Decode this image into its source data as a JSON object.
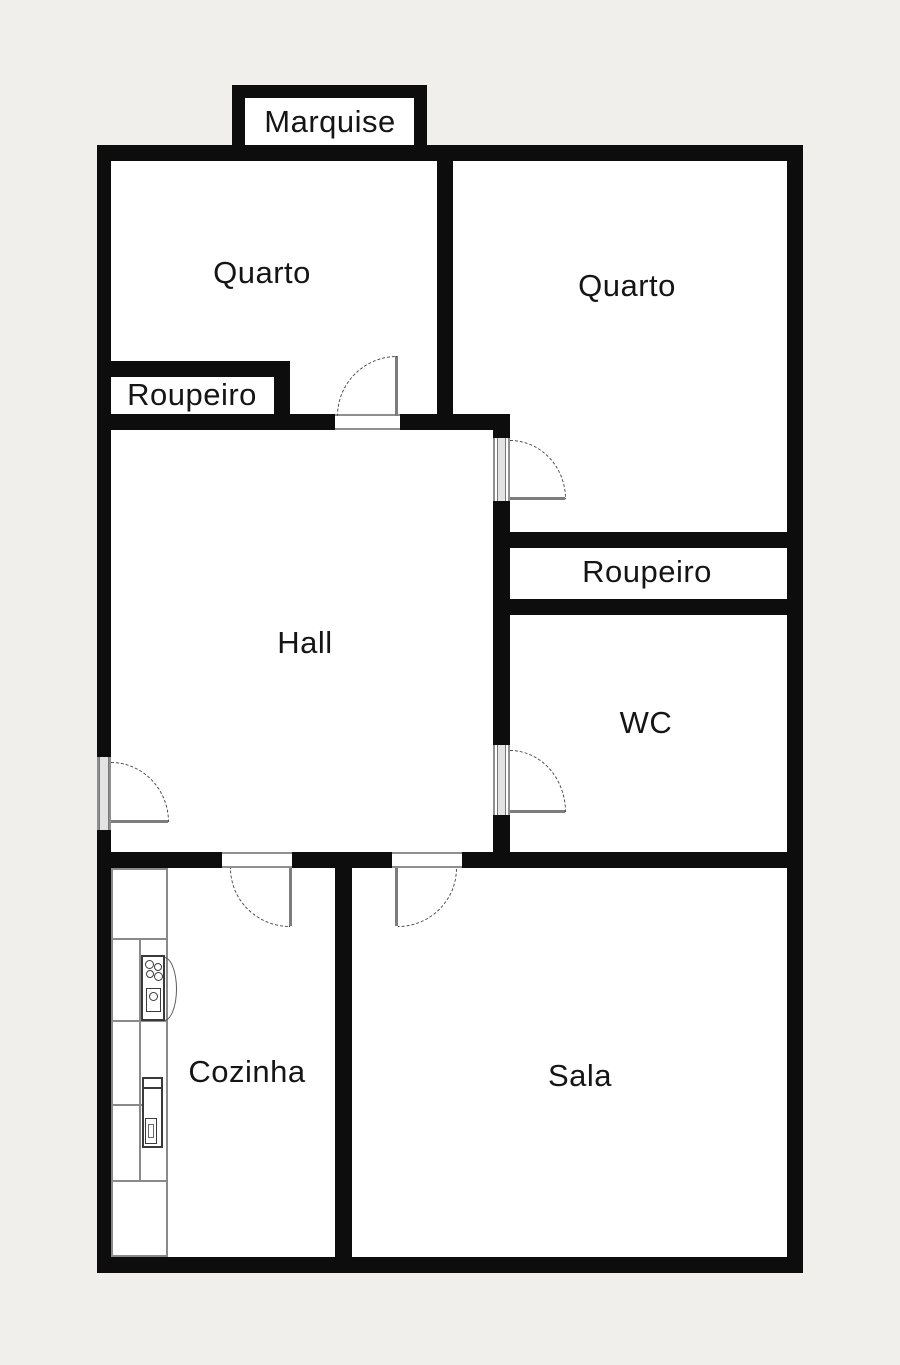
{
  "type": "floor-plan",
  "colors": {
    "wall": "#0d0d0d",
    "floor": "#ffffff",
    "background": "#f0efeb",
    "fixture_line": "#777777",
    "text": "#151515"
  },
  "rooms": {
    "marquise": {
      "label": "Marquise"
    },
    "quarto_left": {
      "label": "Quarto"
    },
    "quarto_right": {
      "label": "Quarto"
    },
    "roupeiro_left": {
      "label": "Roupeiro"
    },
    "hall": {
      "label": "Hall"
    },
    "roupeiro_right": {
      "label": "Roupeiro"
    },
    "wc": {
      "label": "WC"
    },
    "cozinha": {
      "label": "Cozinha"
    },
    "sala": {
      "label": "Sala"
    }
  },
  "doors": [
    "entry-door",
    "quarto-left-door",
    "quarto-right-door",
    "wc-door",
    "cozinha-door",
    "sala-door"
  ],
  "fixtures": [
    "kitchen-counter",
    "stove",
    "kitchen-sink"
  ]
}
